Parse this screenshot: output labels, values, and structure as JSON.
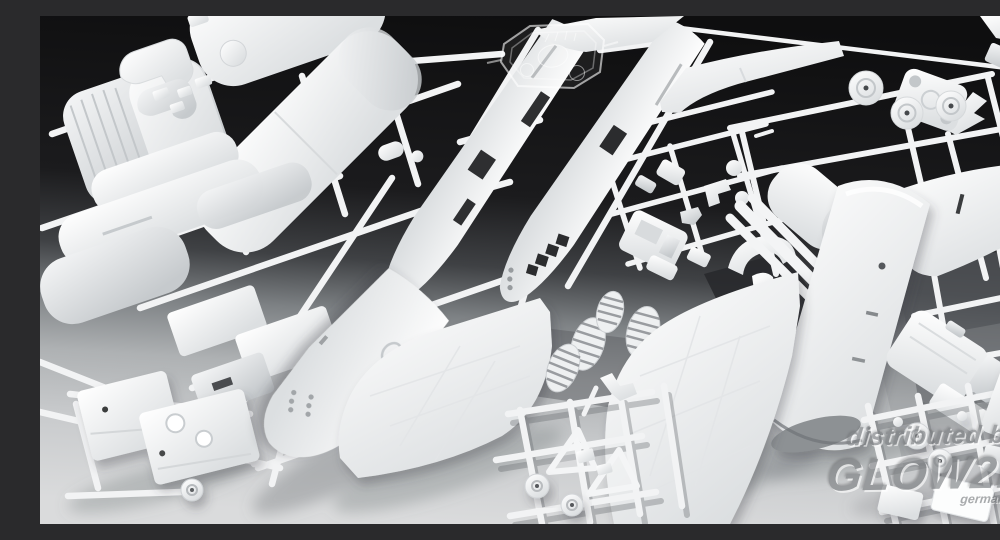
{
  "photo": {
    "kind": "studio product photograph",
    "subject": "white injection-molded plastic model kit sprues of an aircraft kit",
    "visible_parts": [
      "fuselage half left",
      "fuselage half right with cockpit window cutouts",
      "nose section with portholes",
      "swept wing left with panel lines",
      "swept wing right with panel lines",
      "far right wing panel",
      "tail fin",
      "tail cone cylinder section",
      "engine nacelle shells",
      "ridged barrel section",
      "arched fuselage panels",
      "intake elbow ducts",
      "engine block parts",
      "cockpit small parts",
      "ribbed oval parts",
      "wheel hub discs",
      "landing gear triangles and wheels",
      "clear canopy parts sprue"
    ],
    "background": "gradient from near-black top to light grey bottom"
  },
  "watermark": {
    "prefix": "distributed by",
    "brand": "GLOW2B",
    "country": "germany"
  },
  "palette": {
    "background_top": "#0e0e0f",
    "background_bottom": "#dadbdc",
    "plastic_white": "#ffffff",
    "plastic_shadow": "#c6cacd",
    "runner_white": "#f2f3f4",
    "watermark_gray": "#7e8184"
  }
}
